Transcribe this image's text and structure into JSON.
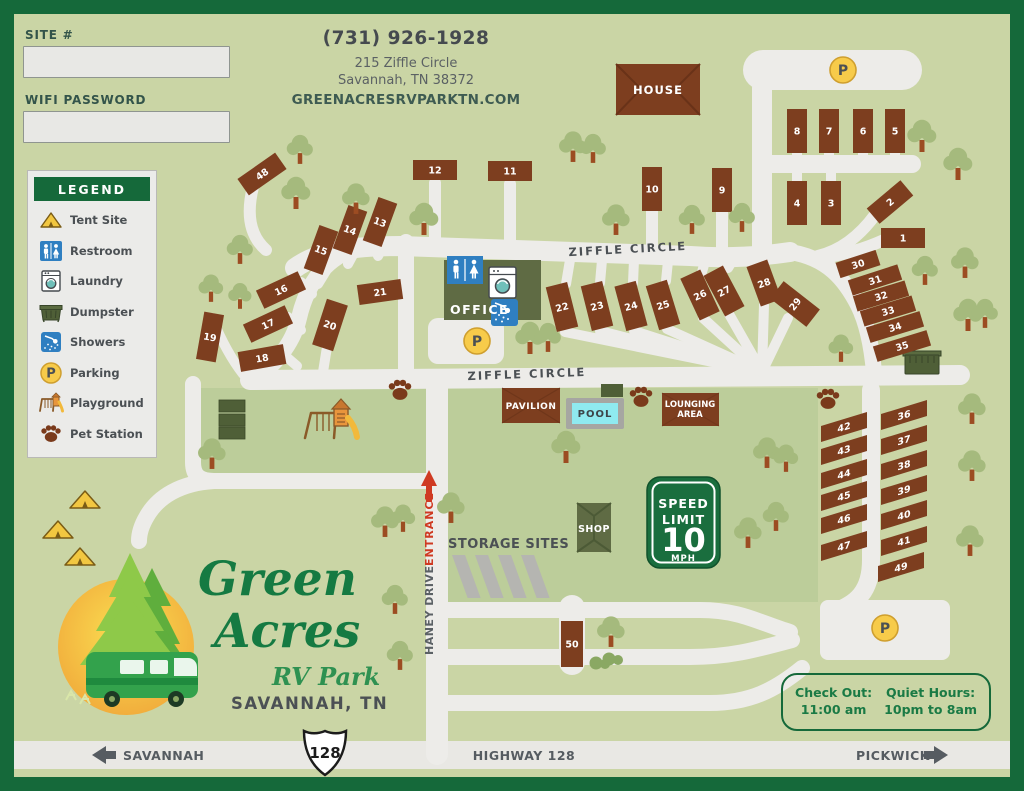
{
  "form": {
    "site_label": "SITE #",
    "wifi_label": "WIFI PASSWORD",
    "site_value": "",
    "wifi_value": ""
  },
  "contact": {
    "phone": "(731) 926-1928",
    "address_line1": "215 Ziffle Circle",
    "address_line2": "Savannah, TN 38372",
    "website": "GREENACRESRVPARKTN.COM"
  },
  "legend": {
    "title": "LEGEND",
    "items": [
      {
        "icon": "tent-icon",
        "label": "Tent Site"
      },
      {
        "icon": "restroom-icon",
        "label": "Restroom"
      },
      {
        "icon": "laundry-icon",
        "label": "Laundry"
      },
      {
        "icon": "dumpster-icon",
        "label": "Dumpster"
      },
      {
        "icon": "showers-icon",
        "label": "Showers"
      },
      {
        "icon": "parking-icon",
        "label": "Parking"
      },
      {
        "icon": "playground-icon",
        "label": "Playground"
      },
      {
        "icon": "pet-station-icon",
        "label": "Pet Station"
      }
    ]
  },
  "map": {
    "street_labels": {
      "ziffle_top": "ZIFFLE CIRCLE",
      "ziffle_bottom": "ZIFFLE CIRCLE",
      "haney": "HANEY DRIVE",
      "entrance": "ENTRANCE"
    },
    "building_labels": {
      "house": "HOUSE",
      "office": "OFFICE",
      "pavilion": "PAVILION",
      "pool": "POOL",
      "lounging_line1": "LOUNGING",
      "lounging_line2": "AREA",
      "shop": "SHOP",
      "storage": "STORAGE SITES"
    },
    "speed_sign": {
      "line1": "SPEED",
      "line2": "LIMIT",
      "value": "10",
      "unit": "MPH"
    },
    "parking_letter": "P",
    "sites": [
      {
        "n": "1",
        "x": 903,
        "y": 238,
        "w": 44,
        "h": 20,
        "r": 0
      },
      {
        "n": "2",
        "x": 890,
        "y": 202,
        "w": 44,
        "h": 20,
        "r": -40
      },
      {
        "n": "3",
        "x": 831,
        "y": 203,
        "w": 20,
        "h": 44,
        "r": 0
      },
      {
        "n": "4",
        "x": 797,
        "y": 203,
        "w": 20,
        "h": 44,
        "r": 0
      },
      {
        "n": "5",
        "x": 895,
        "y": 131,
        "w": 20,
        "h": 44,
        "r": 0
      },
      {
        "n": "6",
        "x": 863,
        "y": 131,
        "w": 20,
        "h": 44,
        "r": 0
      },
      {
        "n": "7",
        "x": 829,
        "y": 131,
        "w": 20,
        "h": 44,
        "r": 0
      },
      {
        "n": "8",
        "x": 797,
        "y": 131,
        "w": 20,
        "h": 44,
        "r": 0
      },
      {
        "n": "9",
        "x": 722,
        "y": 190,
        "w": 20,
        "h": 44,
        "r": 0
      },
      {
        "n": "10",
        "x": 652,
        "y": 189,
        "w": 20,
        "h": 44,
        "r": 0
      },
      {
        "n": "11",
        "x": 510,
        "y": 171,
        "w": 44,
        "h": 20,
        "r": 0
      },
      {
        "n": "12",
        "x": 435,
        "y": 170,
        "w": 44,
        "h": 20,
        "r": 0
      },
      {
        "n": "13",
        "x": 380,
        "y": 222,
        "w": 20,
        "h": 46,
        "r": 20
      },
      {
        "n": "14",
        "x": 350,
        "y": 230,
        "w": 20,
        "h": 46,
        "r": 20
      },
      {
        "n": "15",
        "x": 321,
        "y": 250,
        "w": 20,
        "h": 46,
        "r": 20
      },
      {
        "n": "16",
        "x": 281,
        "y": 290,
        "w": 46,
        "h": 20,
        "r": -25
      },
      {
        "n": "17",
        "x": 268,
        "y": 324,
        "w": 46,
        "h": 20,
        "r": -25
      },
      {
        "n": "18",
        "x": 262,
        "y": 358,
        "w": 46,
        "h": 20,
        "r": -10
      },
      {
        "n": "19",
        "x": 210,
        "y": 337,
        "w": 20,
        "h": 48,
        "r": 10
      },
      {
        "n": "20",
        "x": 330,
        "y": 325,
        "w": 22,
        "h": 48,
        "r": 18
      },
      {
        "n": "21",
        "x": 380,
        "y": 292,
        "w": 44,
        "h": 20,
        "r": -8
      },
      {
        "n": "22",
        "x": 562,
        "y": 307,
        "w": 22,
        "h": 46,
        "r": -14
      },
      {
        "n": "23",
        "x": 597,
        "y": 306,
        "w": 22,
        "h": 46,
        "r": -14
      },
      {
        "n": "24",
        "x": 631,
        "y": 306,
        "w": 22,
        "h": 46,
        "r": -15
      },
      {
        "n": "25",
        "x": 663,
        "y": 305,
        "w": 22,
        "h": 46,
        "r": -17
      },
      {
        "n": "26",
        "x": 700,
        "y": 295,
        "w": 22,
        "h": 46,
        "r": -25
      },
      {
        "n": "27",
        "x": 724,
        "y": 291,
        "w": 22,
        "h": 46,
        "r": -28
      },
      {
        "n": "28",
        "x": 764,
        "y": 283,
        "w": 22,
        "h": 42,
        "r": -20
      },
      {
        "n": "29",
        "x": 795,
        "y": 304,
        "w": 22,
        "h": 46,
        "r": -52
      },
      {
        "n": "30",
        "x": 858,
        "y": 264,
        "w": 42,
        "h": 16,
        "r": -18
      },
      {
        "n": "31",
        "x": 875,
        "y": 280,
        "w": 52,
        "h": 16,
        "r": -18
      },
      {
        "n": "32",
        "x": 881,
        "y": 296,
        "w": 54,
        "h": 16,
        "r": -17
      },
      {
        "n": "33",
        "x": 888,
        "y": 311,
        "w": 54,
        "h": 16,
        "r": -17
      },
      {
        "n": "34",
        "x": 895,
        "y": 327,
        "w": 56,
        "h": 16,
        "r": -17
      },
      {
        "n": "35",
        "x": 902,
        "y": 346,
        "w": 56,
        "h": 16,
        "r": -17
      },
      {
        "n": "36",
        "x": 904,
        "y": 415,
        "w": 46,
        "h": 16,
        "p": 1
      },
      {
        "n": "37",
        "x": 904,
        "y": 440,
        "w": 46,
        "h": 16,
        "p": 1
      },
      {
        "n": "38",
        "x": 904,
        "y": 465,
        "w": 46,
        "h": 16,
        "p": 1
      },
      {
        "n": "39",
        "x": 904,
        "y": 490,
        "w": 46,
        "h": 16,
        "p": 1
      },
      {
        "n": "40",
        "x": 904,
        "y": 515,
        "w": 46,
        "h": 16,
        "p": 1
      },
      {
        "n": "41",
        "x": 904,
        "y": 541,
        "w": 46,
        "h": 16,
        "p": 1
      },
      {
        "n": "42",
        "x": 844,
        "y": 427,
        "w": 46,
        "h": 16,
        "p": 1
      },
      {
        "n": "43",
        "x": 844,
        "y": 450,
        "w": 46,
        "h": 16,
        "p": 1
      },
      {
        "n": "44",
        "x": 844,
        "y": 474,
        "w": 46,
        "h": 16,
        "p": 1
      },
      {
        "n": "45",
        "x": 844,
        "y": 496,
        "w": 46,
        "h": 16,
        "p": 1
      },
      {
        "n": "46",
        "x": 844,
        "y": 519,
        "w": 46,
        "h": 16,
        "p": 1
      },
      {
        "n": "47",
        "x": 844,
        "y": 546,
        "w": 46,
        "h": 16,
        "p": 1
      },
      {
        "n": "48",
        "x": 262,
        "y": 174,
        "w": 46,
        "h": 20,
        "r": -35
      },
      {
        "n": "49",
        "x": 901,
        "y": 567,
        "w": 46,
        "h": 16,
        "p": 1
      },
      {
        "n": "50",
        "x": 572,
        "y": 644,
        "w": 22,
        "h": 46,
        "r": 0
      }
    ],
    "trees": [
      [
        300,
        163,
        0.9
      ],
      [
        296,
        208,
        1
      ],
      [
        356,
        213,
        0.95
      ],
      [
        424,
        234,
        1
      ],
      [
        240,
        263,
        0.9
      ],
      [
        211,
        301,
        0.85
      ],
      [
        240,
        308,
        0.8
      ],
      [
        573,
        161,
        0.95
      ],
      [
        593,
        162,
        0.9
      ],
      [
        616,
        234,
        0.95
      ],
      [
        692,
        233,
        0.9
      ],
      [
        742,
        231,
        0.9
      ],
      [
        922,
        151,
        1
      ],
      [
        958,
        179,
        1
      ],
      [
        965,
        277,
        0.95
      ],
      [
        925,
        284,
        0.9
      ],
      [
        968,
        330,
        1
      ],
      [
        985,
        327,
        0.9
      ],
      [
        841,
        361,
        0.85
      ],
      [
        530,
        353,
        1
      ],
      [
        548,
        351,
        0.9
      ],
      [
        566,
        462,
        1
      ],
      [
        767,
        467,
        0.95
      ],
      [
        786,
        471,
        0.85
      ],
      [
        776,
        530,
        0.9
      ],
      [
        748,
        547,
        0.95
      ],
      [
        972,
        423,
        0.95
      ],
      [
        972,
        480,
        0.95
      ],
      [
        970,
        555,
        0.95
      ],
      [
        451,
        522,
        0.95
      ],
      [
        385,
        536,
        0.95
      ],
      [
        403,
        531,
        0.85
      ],
      [
        395,
        613,
        0.9
      ],
      [
        400,
        669,
        0.9
      ],
      [
        212,
        468,
        0.95
      ],
      [
        611,
        646,
        0.95
      ]
    ],
    "tents": [
      [
        85,
        500
      ],
      [
        58,
        530
      ],
      [
        80,
        557
      ]
    ],
    "paws": [
      [
        400,
        391
      ],
      [
        641,
        398
      ],
      [
        828,
        400
      ]
    ],
    "parking_markers": [
      [
        843,
        70
      ],
      [
        477,
        341
      ],
      [
        885,
        628
      ]
    ],
    "bushes": [
      [
        600,
        663
      ],
      [
        613,
        659
      ]
    ]
  },
  "logo": {
    "word1": "Green",
    "word2": "Acres",
    "word3": "RV Park",
    "location": "SAVANNAH, TN"
  },
  "info_box": {
    "checkout_label": "Check Out:",
    "checkout_time": "11:00 am",
    "quiet_label": "Quiet Hours:",
    "quiet_hours": "10pm to 8am"
  },
  "highway": {
    "left_city": "SAVANNAH",
    "route_shield": "128",
    "label": "HIGHWAY 128",
    "right_city": "PICKWICK"
  },
  "colors": {
    "frame": "#15693a",
    "grass": "#cad5a5",
    "grass_dark": "#bccd9a",
    "road": "#edece9",
    "site_brown": "#7d3e1f",
    "building_olive": "#5f6b44",
    "dark_green_box": "#4f5f37",
    "tree": "#a5ba7d",
    "trunk": "#9c4c22",
    "parking_yellow": "#f7cb4a",
    "pool_water": "#8feaf0",
    "sign_green": "#1a6e3e",
    "entrance_red": "#cf3a22",
    "text_dark": "#4b5054",
    "logo_green": "#157a42"
  }
}
